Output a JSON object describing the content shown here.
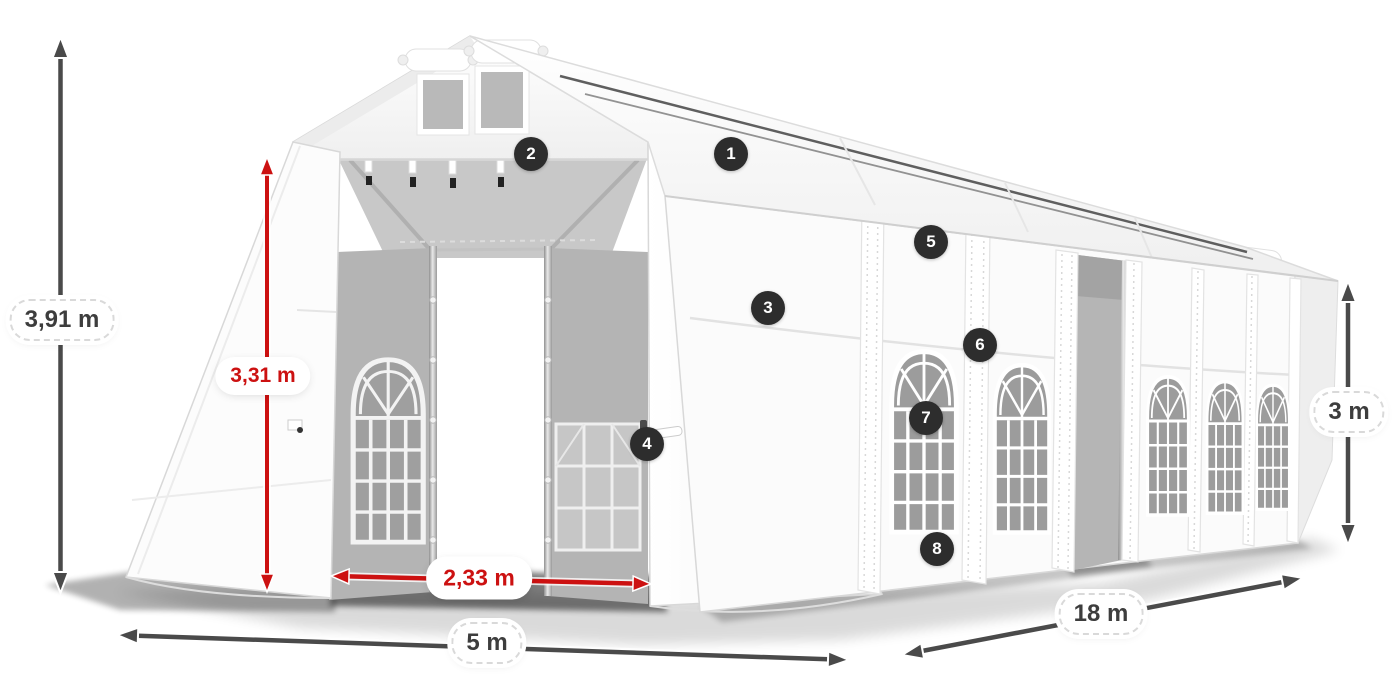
{
  "diagram": {
    "dimension_labels": {
      "overall_height": "3,91 m",
      "entrance_height": "3,31 m",
      "entrance_width": "2,33 m",
      "front_width": "5 m",
      "side_length": "18 m",
      "side_wall_height": "3 m"
    },
    "feature_markers": [
      {
        "number": "1"
      },
      {
        "number": "2"
      },
      {
        "number": "3"
      },
      {
        "number": "4"
      },
      {
        "number": "5"
      },
      {
        "number": "6"
      },
      {
        "number": "7"
      },
      {
        "number": "8"
      }
    ],
    "colors": {
      "dimension_arrow_gray": "#4a4a4a",
      "dimension_arrow_red": "#cc1111",
      "marker_background": "#2d2d2d",
      "marker_text": "#ffffff",
      "tent_fabric": "#ffffff",
      "interior_gray": "#b4b4b4",
      "window_glass_gray": "#9c9c9c"
    }
  }
}
